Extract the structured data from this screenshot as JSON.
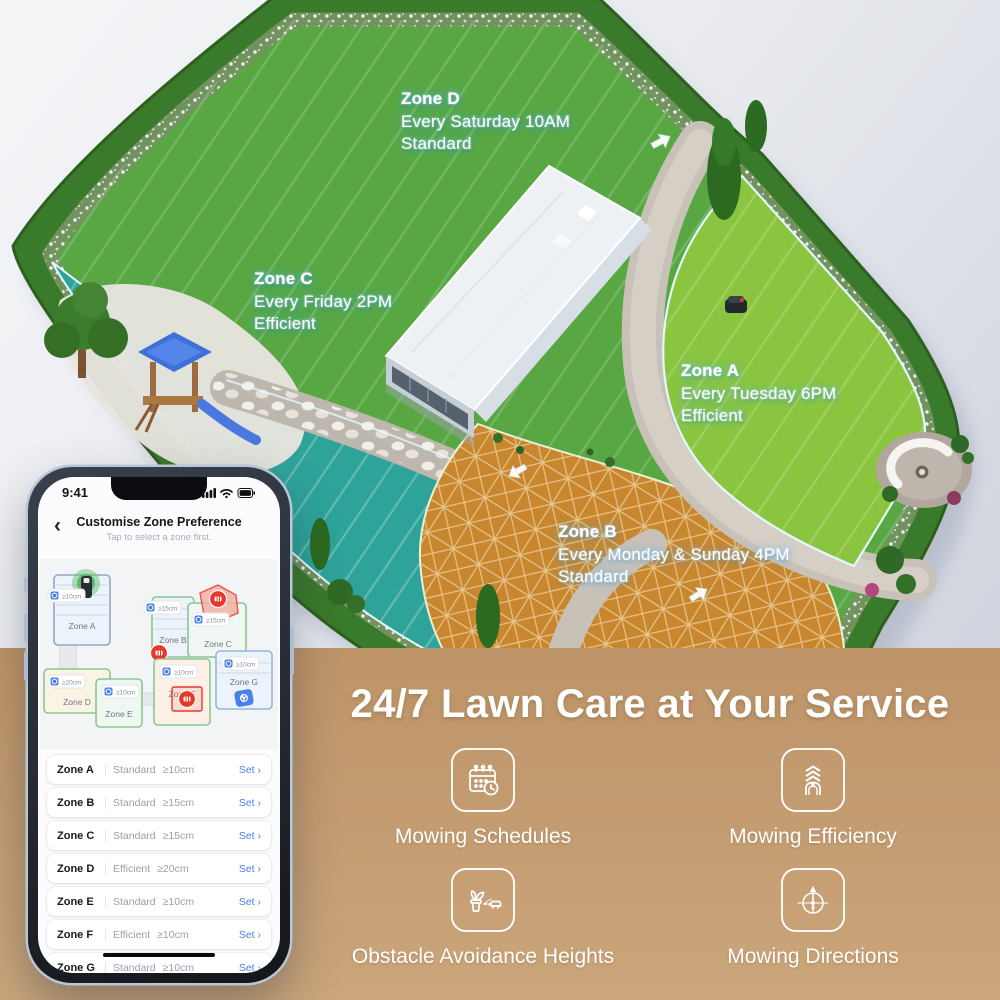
{
  "garden": {
    "labels": [
      {
        "name": "Zone D",
        "schedule": "Every Saturday 10AM",
        "mode": "Standard"
      },
      {
        "name": "Zone C",
        "schedule": "Every Friday 2PM",
        "mode": "Efficient"
      },
      {
        "name": "Zone A",
        "schedule": "Every Tuesday 6PM",
        "mode": "Efficient"
      },
      {
        "name": "Zone B",
        "schedule": "Every Monday & Sunday 4PM",
        "mode": "Standard"
      }
    ]
  },
  "phone": {
    "status_time": "9:41",
    "back_icon": "‹",
    "title": "Customise Zone Preference",
    "subtitle": "Tap to select a zone first.",
    "map_zones": [
      {
        "name": "Zone A",
        "height": "≥10cm"
      },
      {
        "name": "Zone B",
        "height": "≥15cm"
      },
      {
        "name": "Zone C",
        "height": "≥15cm"
      },
      {
        "name": "Zone D",
        "height": "≥20cm"
      },
      {
        "name": "Zone E",
        "height": "≥10cm"
      },
      {
        "name": "Zone F",
        "height": "≥10cm"
      },
      {
        "name": "Zone G",
        "height": "≥10cm"
      }
    ],
    "list_rows": [
      {
        "zone": "Zone A",
        "mode": "Standard",
        "height": "≥10cm",
        "action": "Set ›"
      },
      {
        "zone": "Zone B",
        "mode": "Standard",
        "height": "≥15cm",
        "action": "Set ›"
      },
      {
        "zone": "Zone C",
        "mode": "Standard",
        "height": "≥15cm",
        "action": "Set ›"
      },
      {
        "zone": "Zone D",
        "mode": "Efficient",
        "height": "≥20cm",
        "action": "Set ›"
      },
      {
        "zone": "Zone E",
        "mode": "Standard",
        "height": "≥10cm",
        "action": "Set ›"
      },
      {
        "zone": "Zone F",
        "mode": "Efficient",
        "height": "≥10cm",
        "action": "Set ›"
      },
      {
        "zone": "Zone G",
        "mode": "Standard",
        "height": "≥10cm",
        "action": "Set ›"
      }
    ]
  },
  "promo": {
    "heading": "24/7 Lawn Care at Your Service",
    "features": [
      {
        "label": "Mowing Schedules"
      },
      {
        "label": "Mowing Efficiency"
      },
      {
        "label": "Obstacle Avoidance Heights"
      },
      {
        "label": "Mowing Directions"
      }
    ]
  },
  "colors": {
    "band": "#c39a6d",
    "zone_d_green": "#58a743",
    "zone_a_green": "#8bc53f",
    "zone_c_teal": "#2ea39a",
    "zone_b_orange": "#c8862f",
    "hedge": "#3a7a2b",
    "accent_blue": "#4a80e9",
    "alert_red": "#e6392b"
  }
}
